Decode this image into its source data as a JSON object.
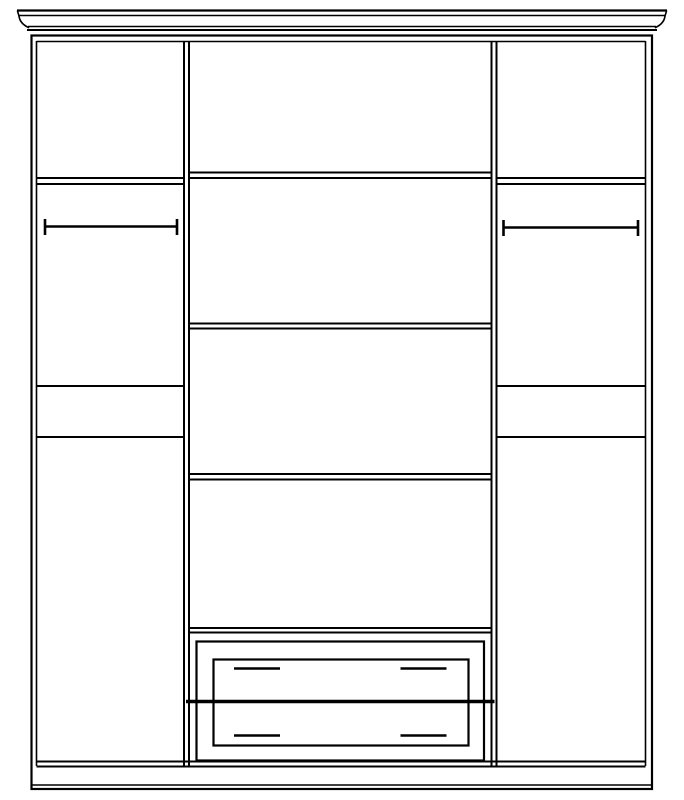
{
  "canvas": {
    "width": 684,
    "height": 800,
    "background": "#ffffff",
    "line_color": "#000000"
  },
  "drawing": {
    "description": "wardrobe-front-elevation-line-drawing",
    "rects": [
      {
        "name": "carcass-outer-rect",
        "x": 31.5,
        "y": 35.5,
        "w": 620.5,
        "h": 753.5,
        "sw": 2.2
      },
      {
        "name": "drawer-outer-frame-rect",
        "x": 196.5,
        "y": 641.5,
        "w": 287.5,
        "h": 119,
        "sw": 2.2
      },
      {
        "name": "drawer-front-panel-rect",
        "x": 213.5,
        "y": 659.5,
        "w": 255,
        "h": 86,
        "sw": 2.2
      }
    ],
    "lines": [
      {
        "name": "crown-top-edge-line",
        "x1": 17,
        "y1": 10.5,
        "x2": 667,
        "y2": 10.5,
        "w": 2.2
      },
      {
        "name": "crown-fascia-line",
        "x1": 18.5,
        "y1": 15.5,
        "x2": 665.5,
        "y2": 15.5,
        "w": 1.5
      },
      {
        "name": "crown-bottom-inner-line",
        "x1": 28,
        "y1": 26.5,
        "x2": 656,
        "y2": 26.5,
        "w": 1.5
      },
      {
        "name": "crown-bottom-outer-line",
        "x1": 27,
        "y1": 30,
        "x2": 657,
        "y2": 30,
        "w": 2
      },
      {
        "name": "carcass-inner-top-line",
        "x1": 36.5,
        "y1": 41.5,
        "x2": 645.5,
        "y2": 41.5,
        "w": 1.6
      },
      {
        "name": "carcass-inner-left-line",
        "x1": 36.5,
        "y1": 41,
        "x2": 36.5,
        "y2": 766,
        "w": 1.6
      },
      {
        "name": "carcass-inner-right-line",
        "x1": 645.5,
        "y1": 41,
        "x2": 645.5,
        "y2": 766,
        "w": 1.6
      },
      {
        "name": "left-partition-outer-line",
        "x1": 184,
        "y1": 41,
        "x2": 184,
        "y2": 766,
        "w": 2
      },
      {
        "name": "left-partition-inner-line",
        "x1": 189,
        "y1": 41,
        "x2": 189,
        "y2": 766,
        "w": 2
      },
      {
        "name": "right-partition-inner-line",
        "x1": 491.5,
        "y1": 41,
        "x2": 491.5,
        "y2": 766,
        "w": 2
      },
      {
        "name": "right-partition-outer-line",
        "x1": 496.5,
        "y1": 41,
        "x2": 496.5,
        "y2": 766,
        "w": 2
      },
      {
        "name": "carcass-bottom-inner-line",
        "x1": 36.5,
        "y1": 761.5,
        "x2": 645.5,
        "y2": 761.5,
        "w": 2
      },
      {
        "name": "carcass-bottom-outer-line",
        "x1": 36.5,
        "y1": 766.5,
        "x2": 645.5,
        "y2": 766.5,
        "w": 2
      },
      {
        "name": "plinth-inner-bottom-line",
        "x1": 32.5,
        "y1": 785,
        "x2": 651.5,
        "y2": 785,
        "w": 1.6
      },
      {
        "name": "left-top-shelf-upper-line",
        "x1": 36.5,
        "y1": 178,
        "x2": 184,
        "y2": 178,
        "w": 2
      },
      {
        "name": "left-top-shelf-lower-line",
        "x1": 36.5,
        "y1": 184,
        "x2": 184,
        "y2": 184,
        "w": 2
      },
      {
        "name": "left-hanging-rail-bar",
        "x1": 44.5,
        "y1": 226.5,
        "x2": 177.5,
        "y2": 226.5,
        "w": 2.6
      },
      {
        "name": "left-hanging-rail-left-bracket",
        "x1": 45,
        "y1": 219,
        "x2": 45,
        "y2": 235,
        "w": 2.6
      },
      {
        "name": "left-hanging-rail-right-bracket",
        "x1": 177,
        "y1": 219,
        "x2": 177,
        "y2": 235,
        "w": 2.6
      },
      {
        "name": "left-mid-shelf-line",
        "x1": 36.5,
        "y1": 386,
        "x2": 184,
        "y2": 386,
        "w": 2
      },
      {
        "name": "left-low-shelf-line",
        "x1": 36.5,
        "y1": 437,
        "x2": 184,
        "y2": 437,
        "w": 2
      },
      {
        "name": "right-top-shelf-upper-line",
        "x1": 496.5,
        "y1": 178,
        "x2": 645.5,
        "y2": 178,
        "w": 2
      },
      {
        "name": "right-top-shelf-lower-line",
        "x1": 496.5,
        "y1": 184,
        "x2": 645.5,
        "y2": 184,
        "w": 2
      },
      {
        "name": "right-hanging-rail-bar",
        "x1": 503,
        "y1": 227.5,
        "x2": 638.5,
        "y2": 227.5,
        "w": 2.6
      },
      {
        "name": "right-hanging-rail-left-bracket",
        "x1": 503.5,
        "y1": 220,
        "x2": 503.5,
        "y2": 236,
        "w": 2.6
      },
      {
        "name": "right-hanging-rail-right-bracket",
        "x1": 638,
        "y1": 220,
        "x2": 638,
        "y2": 236,
        "w": 2.6
      },
      {
        "name": "right-mid-shelf-line",
        "x1": 496.5,
        "y1": 386,
        "x2": 645.5,
        "y2": 386,
        "w": 2
      },
      {
        "name": "right-low-shelf-line",
        "x1": 496.5,
        "y1": 437,
        "x2": 645.5,
        "y2": 437,
        "w": 2
      },
      {
        "name": "middle-shelf-1-upper-line",
        "x1": 189,
        "y1": 172.5,
        "x2": 491.5,
        "y2": 172.5,
        "w": 2
      },
      {
        "name": "middle-shelf-1-lower-line",
        "x1": 189,
        "y1": 178,
        "x2": 491.5,
        "y2": 178,
        "w": 2
      },
      {
        "name": "middle-shelf-2-upper-line",
        "x1": 189,
        "y1": 323.5,
        "x2": 491.5,
        "y2": 323.5,
        "w": 2
      },
      {
        "name": "middle-shelf-2-lower-line",
        "x1": 189,
        "y1": 328.5,
        "x2": 491.5,
        "y2": 328.5,
        "w": 2
      },
      {
        "name": "middle-shelf-3-upper-line",
        "x1": 189,
        "y1": 474,
        "x2": 491.5,
        "y2": 474,
        "w": 2
      },
      {
        "name": "middle-shelf-3-lower-line",
        "x1": 189,
        "y1": 479.5,
        "x2": 491.5,
        "y2": 479.5,
        "w": 2
      },
      {
        "name": "drawer-unit-top-upper-line",
        "x1": 189,
        "y1": 628,
        "x2": 491.5,
        "y2": 628,
        "w": 2
      },
      {
        "name": "drawer-unit-top-lower-line",
        "x1": 189,
        "y1": 632.5,
        "x2": 491.5,
        "y2": 632.5,
        "w": 2
      },
      {
        "name": "drawer-divider-line",
        "x1": 186,
        "y1": 701.5,
        "x2": 494.5,
        "y2": 701.5,
        "w": 3.6
      },
      {
        "name": "drawer-1-left-handle",
        "x1": 234,
        "y1": 668.5,
        "x2": 280,
        "y2": 668.5,
        "w": 2.6
      },
      {
        "name": "drawer-1-right-handle",
        "x1": 400.5,
        "y1": 668.5,
        "x2": 446.5,
        "y2": 668.5,
        "w": 2.6
      },
      {
        "name": "drawer-2-left-handle",
        "x1": 234,
        "y1": 735.5,
        "x2": 280,
        "y2": 735.5,
        "w": 2.6
      },
      {
        "name": "drawer-2-right-handle",
        "x1": 400.5,
        "y1": 735.5,
        "x2": 446.5,
        "y2": 735.5,
        "w": 2.6
      }
    ],
    "paths": [
      {
        "name": "crown-left-ogee-profile",
        "d": "M 17.5,11 L 19,16 C 19.5,20.5 22,24.5 28.5,27.5",
        "sw": 1.6
      },
      {
        "name": "crown-right-ogee-profile",
        "d": "M 666.5,11 L 665,16 C 664.5,20.5 662,24.5 655.5,27.5",
        "sw": 1.6
      }
    ]
  }
}
